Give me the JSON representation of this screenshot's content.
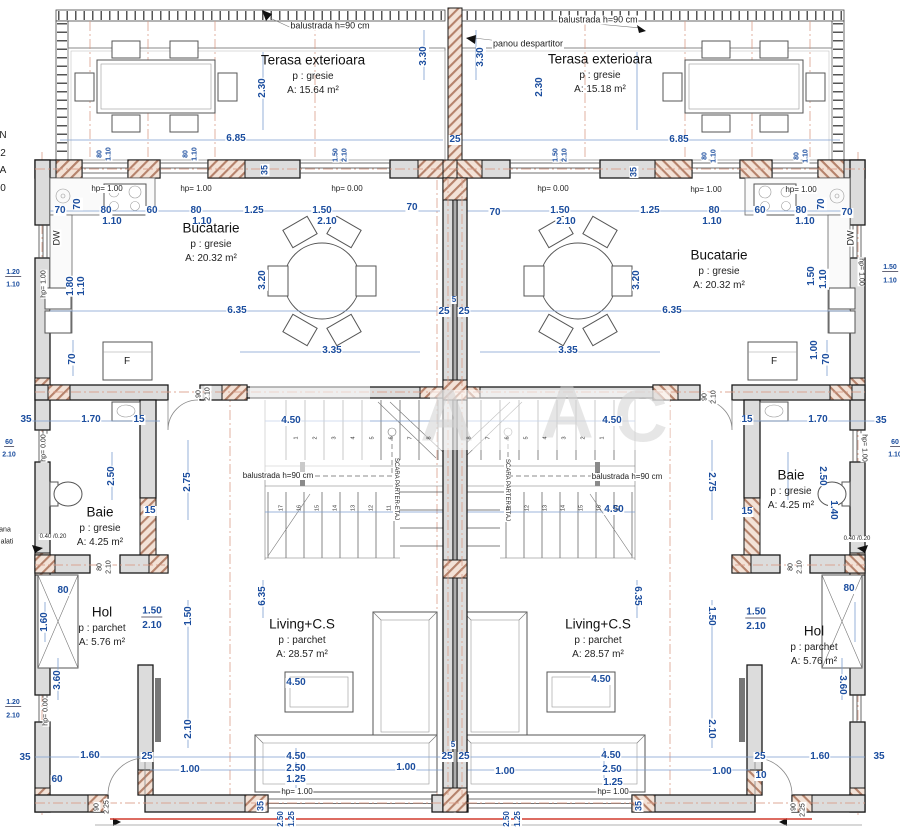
{
  "meta": {
    "drawing_type": "floor-plan-duplex",
    "dim_color": "#1b4d9e",
    "wall_fill": "#dcdcdc",
    "hatch_color": "#b5826b",
    "centerline_color": "#d99a85",
    "red_line_color": "#d23b2f"
  },
  "rooms": [
    {
      "name": "Terasa exterioara",
      "floor": "p : gresie",
      "area": "A: 15.64 m²",
      "x": 313,
      "y": 60
    },
    {
      "name": "Terasa exterioara",
      "floor": "p : gresie",
      "area": "A: 15.18 m²",
      "x": 600,
      "y": 59
    },
    {
      "name": "Bucatarie",
      "floor": "p : gresie",
      "area": "A: 20.32 m²",
      "x": 211,
      "y": 228
    },
    {
      "name": "Bucatarie",
      "floor": "p : gresie",
      "area": "A: 20.32 m²",
      "x": 719,
      "y": 255
    },
    {
      "name": "Baie",
      "floor": "p : gresie",
      "area": "A: 4.25 m²",
      "x": 100,
      "y": 512
    },
    {
      "name": "Baie",
      "floor": "p : gresie",
      "area": "A: 4.25 m²",
      "x": 791,
      "y": 475
    },
    {
      "name": "Hol",
      "floor": "p : parchet",
      "area": "A: 5.76 m²",
      "x": 102,
      "y": 612
    },
    {
      "name": "Hol",
      "floor": "p : parchet",
      "area": "A: 5.76 m²",
      "x": 814,
      "y": 631
    },
    {
      "name": "Living+C.S",
      "floor": "p : parchet",
      "area": "A: 28.57 m²",
      "x": 302,
      "y": 624
    },
    {
      "name": "Living+C.S",
      "floor": "p : parchet",
      "area": "A: 28.57 m²",
      "x": 598,
      "y": 624
    }
  ],
  "dims": [
    [
      "2.30",
      263,
      88,
      -90
    ],
    [
      "3.30",
      424,
      56,
      -90
    ],
    [
      "3.30",
      481,
      57,
      -90
    ],
    [
      "2.30",
      540,
      87,
      -90
    ],
    [
      "6.85",
      236,
      139
    ],
    [
      "25",
      455,
      140
    ],
    [
      "6.85",
      679,
      140
    ],
    [
      "80",
      100,
      154,
      -90,
      7
    ],
    [
      "1.10",
      109,
      154,
      -90,
      7
    ],
    [
      "80",
      186,
      154,
      -90,
      7
    ],
    [
      "1.10",
      195,
      154,
      -90,
      7
    ],
    [
      "1.50",
      336,
      155,
      -90,
      7
    ],
    [
      "2.10",
      345,
      155,
      -90,
      7
    ],
    [
      "1.50",
      556,
      155,
      -90,
      7
    ],
    [
      "2.10",
      565,
      155,
      -90,
      7
    ],
    [
      "80",
      705,
      156,
      -90,
      7
    ],
    [
      "1.10",
      714,
      156,
      -90,
      7
    ],
    [
      "80",
      797,
      156,
      -90,
      7
    ],
    [
      "1.10",
      806,
      156,
      -90,
      7
    ],
    [
      "35",
      265,
      170,
      -90,
      9
    ],
    [
      "35",
      634,
      172,
      -90,
      9
    ],
    [
      "70",
      60,
      211
    ],
    [
      "70",
      78,
      204,
      -90
    ],
    [
      "80",
      106,
      211
    ],
    [
      "1.10",
      112,
      222
    ],
    [
      "60",
      152,
      211
    ],
    [
      "80",
      196,
      211
    ],
    [
      "1.10",
      202,
      222
    ],
    [
      "1.25",
      254,
      211
    ],
    [
      "1.50",
      322,
      211
    ],
    [
      "2.10",
      327,
      222
    ],
    [
      "70",
      412,
      208
    ],
    [
      "70",
      495,
      213
    ],
    [
      "1.50",
      560,
      211
    ],
    [
      "2.10",
      566,
      222
    ],
    [
      "1.25",
      650,
      211
    ],
    [
      "80",
      714,
      211
    ],
    [
      "1.10",
      712,
      222
    ],
    [
      "60",
      760,
      211
    ],
    [
      "80",
      801,
      211
    ],
    [
      "1.10",
      805,
      222
    ],
    [
      "70",
      822,
      204,
      -90
    ],
    [
      "70",
      847,
      213
    ],
    [
      "1.80",
      71,
      286,
      -90
    ],
    [
      "1.10",
      82,
      286,
      -90
    ],
    [
      "1.50",
      812,
      276,
      -90
    ],
    [
      "1.10",
      824,
      279,
      -90
    ],
    [
      "1.00",
      815,
      350,
      -90
    ],
    [
      "1.20",
      13,
      273,
      0,
      7,
      1
    ],
    [
      "1.10",
      13,
      285,
      0,
      7
    ],
    [
      "60",
      9,
      443,
      0,
      7,
      1
    ],
    [
      "2.10",
      9,
      455,
      0,
      7
    ],
    [
      "1.20",
      13,
      703,
      0,
      7,
      1
    ],
    [
      "2.10",
      13,
      716,
      0,
      7
    ],
    [
      "1.50",
      890,
      268,
      0,
      7,
      1
    ],
    [
      "1.10",
      890,
      281,
      0,
      7
    ],
    [
      "60",
      895,
      443,
      0,
      7,
      1
    ],
    [
      "1.10",
      895,
      455,
      0,
      7
    ],
    [
      "3.20",
      263,
      280,
      -90
    ],
    [
      "3.20",
      637,
      280,
      -90
    ],
    [
      "6.35",
      237,
      311
    ],
    [
      "25",
      444,
      312
    ],
    [
      "5",
      454,
      300,
      0,
      8
    ],
    [
      "25",
      464,
      312
    ],
    [
      "6.35",
      672,
      311
    ],
    [
      "3.35",
      332,
      351
    ],
    [
      "3.35",
      568,
      351
    ],
    [
      "70",
      73,
      359,
      -90
    ],
    [
      "70",
      827,
      359,
      -90
    ],
    [
      "35",
      26,
      420
    ],
    [
      "1.70",
      91,
      420
    ],
    [
      "15",
      139,
      420
    ],
    [
      "4.50",
      291,
      421
    ],
    [
      "4.50",
      612,
      421
    ],
    [
      "15",
      747,
      420
    ],
    [
      "1.70",
      818,
      420
    ],
    [
      "35",
      881,
      421
    ],
    [
      "2.50",
      112,
      476,
      -90
    ],
    [
      "2.75",
      188,
      482,
      -90
    ],
    [
      "2.75",
      711,
      482,
      90
    ],
    [
      "2.50",
      822,
      476,
      90
    ],
    [
      "1.40",
      833,
      510,
      90
    ],
    [
      "15",
      150,
      511
    ],
    [
      "15",
      747,
      512
    ],
    [
      "4.50",
      614,
      510
    ],
    [
      "80",
      63,
      591
    ],
    [
      "80",
      849,
      589
    ],
    [
      "1.60",
      45,
      622,
      -90
    ],
    [
      "3.60",
      58,
      680,
      -90
    ],
    [
      "3.60",
      842,
      685,
      90
    ],
    [
      "1.50",
      152,
      612,
      0,
      10,
      1
    ],
    [
      "2.10",
      152,
      626
    ],
    [
      "1.50",
      756,
      613,
      0,
      10,
      1
    ],
    [
      "2.10",
      756,
      627
    ],
    [
      "1.50",
      189,
      616,
      -90
    ],
    [
      "1.50",
      711,
      616,
      90
    ],
    [
      "6.35",
      263,
      596,
      -90
    ],
    [
      "6.35",
      637,
      596,
      90
    ],
    [
      "2.10",
      189,
      729,
      -90
    ],
    [
      "2.10",
      711,
      729,
      90
    ],
    [
      "4.50",
      296,
      683
    ],
    [
      "4.50",
      601,
      680
    ],
    [
      "35",
      25,
      758
    ],
    [
      "1.60",
      90,
      756
    ],
    [
      "25",
      147,
      757
    ],
    [
      "60",
      57,
      780
    ],
    [
      "1.00",
      190,
      770
    ],
    [
      "4.50",
      296,
      757
    ],
    [
      "2.50",
      296,
      769
    ],
    [
      "1.25",
      296,
      780
    ],
    [
      "1.00",
      406,
      768
    ],
    [
      "25",
      447,
      757
    ],
    [
      "5",
      453,
      745,
      0,
      8
    ],
    [
      "25",
      464,
      757
    ],
    [
      "1.00",
      505,
      772
    ],
    [
      "4.50",
      611,
      756
    ],
    [
      "2.50",
      612,
      770
    ],
    [
      "1.25",
      613,
      783
    ],
    [
      "1.00",
      722,
      772
    ],
    [
      "25",
      760,
      757
    ],
    [
      "10",
      761,
      776
    ],
    [
      "1.60",
      820,
      757
    ],
    [
      "35",
      879,
      757
    ],
    [
      "35",
      261,
      806,
      -90,
      9
    ],
    [
      "2.50",
      281,
      819,
      -90,
      8
    ],
    [
      "1.25",
      292,
      819,
      -90,
      8
    ],
    [
      "35",
      639,
      806,
      -90,
      9
    ],
    [
      "2.50",
      507,
      819,
      -90,
      8
    ],
    [
      "1.25",
      518,
      819,
      -90,
      8
    ]
  ],
  "annotations": [
    [
      "balustrada h=90 cm",
      330,
      26,
      0,
      9
    ],
    [
      "balustrada h=90 cm",
      598,
      20,
      0,
      9
    ],
    [
      "panou despartitor",
      528,
      44,
      0,
      9
    ],
    [
      "hp= 1.00",
      107,
      189
    ],
    [
      "hp= 1.00",
      196,
      189
    ],
    [
      "hp= 0.00",
      347,
      189
    ],
    [
      "hp= 0.00",
      553,
      189
    ],
    [
      "hp= 1.00",
      706,
      190
    ],
    [
      "hp= 1.00",
      801,
      190
    ],
    [
      "DW",
      57,
      238,
      -90,
      9
    ],
    [
      "DW",
      851,
      238,
      -90,
      9
    ],
    [
      "hp= 1.00",
      44,
      284,
      -90,
      7
    ],
    [
      "hp= 1.00",
      861,
      272,
      90,
      7
    ],
    [
      "F",
      127,
      362,
      0,
      10
    ],
    [
      "F",
      774,
      362,
      0,
      10
    ],
    [
      "hp= 0.00",
      44,
      448,
      -90,
      7
    ],
    [
      "hp= 1.00",
      864,
      448,
      90,
      7
    ],
    [
      "SCARA PARTER-ETAJ",
      396,
      489,
      90,
      6
    ],
    [
      "SCARA PARTER-ETAJ",
      507,
      490,
      90,
      6
    ],
    [
      "balustrada h=90 cm",
      278,
      476,
      0,
      8
    ],
    [
      "balustrada h=90 cm",
      627,
      477,
      0,
      8
    ],
    [
      "0.40 /0.20",
      53,
      537,
      0,
      6
    ],
    [
      "0.40 /0.20",
      857,
      539,
      0,
      6
    ],
    [
      "hp= 0.00",
      46,
      712,
      -90,
      7
    ],
    [
      "hp= 1.00",
      297,
      792
    ],
    [
      "hp= 1.00",
      613,
      792
    ],
    [
      "90",
      199,
      394,
      -90,
      7
    ],
    [
      "2.10",
      208,
      394,
      -90,
      7
    ],
    [
      "90",
      705,
      397,
      -90,
      7
    ],
    [
      "2.10",
      714,
      397,
      -90,
      7
    ],
    [
      "80",
      100,
      567,
      -90,
      7
    ],
    [
      "2.10",
      109,
      567,
      -90,
      7
    ],
    [
      "80",
      791,
      567,
      -90,
      7
    ],
    [
      "2.10",
      800,
      567,
      -90,
      7
    ],
    [
      "90",
      97,
      807,
      -90,
      7
    ],
    [
      "2.25",
      107,
      807,
      -90,
      7
    ],
    [
      "90",
      794,
      807,
      -90,
      7
    ],
    [
      "2.25",
      803,
      810,
      -90,
      7
    ],
    [
      "N",
      3,
      136,
      0,
      10
    ],
    [
      "2",
      3,
      154,
      0,
      10
    ],
    [
      "A",
      3,
      171,
      0,
      10
    ],
    [
      "0",
      3,
      189,
      0,
      10
    ],
    [
      "ana",
      5,
      530,
      0,
      7
    ],
    [
      "alati",
      7,
      542,
      0,
      7
    ]
  ],
  "stair_steps": [
    {
      "nums": [
        "1",
        "2",
        "3",
        "4",
        "5",
        "6",
        "7",
        "8"
      ],
      "x0": 297,
      "dx": 19,
      "y": 438,
      "r": -90
    },
    {
      "nums": [
        "17",
        "16",
        "15",
        "14",
        "13",
        "12",
        "11"
      ],
      "x0": 282,
      "dx": 18,
      "y": 508,
      "r": -90
    },
    {
      "nums": [
        "1",
        "2",
        "3",
        "4",
        "5",
        "6",
        "7",
        "8"
      ],
      "x0": 603,
      "dx": -19,
      "y": 438,
      "r": -90
    },
    {
      "nums": [
        "17",
        "16",
        "15",
        "14",
        "13",
        "12",
        "11"
      ],
      "x0": 618,
      "dx": -18,
      "y": 508,
      "r": -90
    }
  ],
  "watermark": {
    "letters": [
      {
        "t": "A",
        "x": 447,
        "y": 415
      },
      {
        "t": "A",
        "x": 567,
        "y": 412
      },
      {
        "t": "C",
        "x": 641,
        "y": 416
      }
    ]
  }
}
